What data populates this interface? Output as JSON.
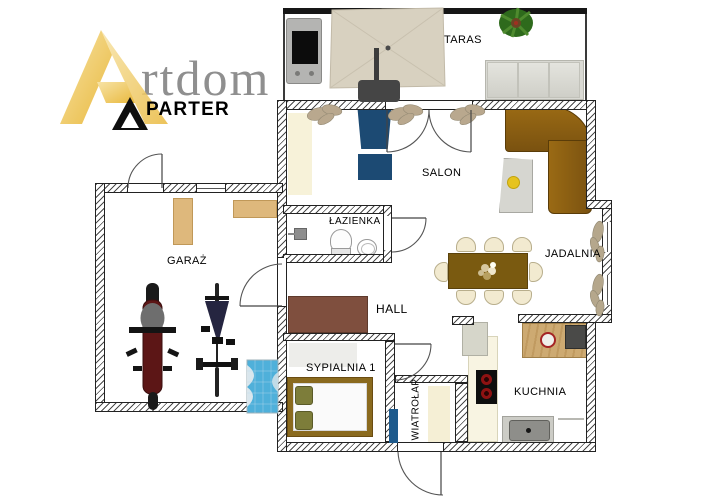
{
  "logo": {
    "brand_mark": "A",
    "brand_text": "rtdom",
    "floor_label": "PARTER",
    "gold": "#EDBE4B",
    "gray": "#8F8F8F"
  },
  "rooms": {
    "taras": {
      "label": "TARAS"
    },
    "salon": {
      "label": "SALON"
    },
    "lazienka": {
      "label": "ŁAZIENKA"
    },
    "jadalnia": {
      "label": "JADALNIA"
    },
    "garaz": {
      "label": "GARAŻ"
    },
    "hall": {
      "label": "HALL"
    },
    "sypialnia": {
      "label": "SYPIALNIA 1"
    },
    "wiatrolap": {
      "label": "WIATROŁAP"
    },
    "kuchnia": {
      "label": "KUCHNIA"
    }
  },
  "palette": {
    "sofa_brown": "#8A5A12",
    "chair_navy": "#1C4A73",
    "table_olive": "#7A5A10",
    "dresser_brown": "#7F4F3E",
    "bed_frame_gold": "#8A6A1E",
    "garage_mat_blue": "#4FB0DA",
    "radiator_blue": "#1E5A8C",
    "cabinet_tan": "#DEB87C",
    "island_wood": "#CDAA72",
    "motorcycle_red": "#5C1616"
  },
  "objects": [
    "grill",
    "parasol",
    "terrace-bench",
    "terrace-plant",
    "corner-sofa",
    "armchair",
    "ottoman",
    "coffee-table",
    "wall-plants",
    "dining-table",
    "dining-chairs",
    "centerpiece",
    "toilet",
    "sink",
    "shower-head",
    "hall-dresser",
    "double-bed",
    "pillows",
    "radiator",
    "entry-rug",
    "fridge-cabinet",
    "kitchen-island",
    "hob",
    "coffee-machine",
    "kitchen-sink",
    "garage-cabinets",
    "motorcycle",
    "bicycle",
    "garage-mat"
  ]
}
